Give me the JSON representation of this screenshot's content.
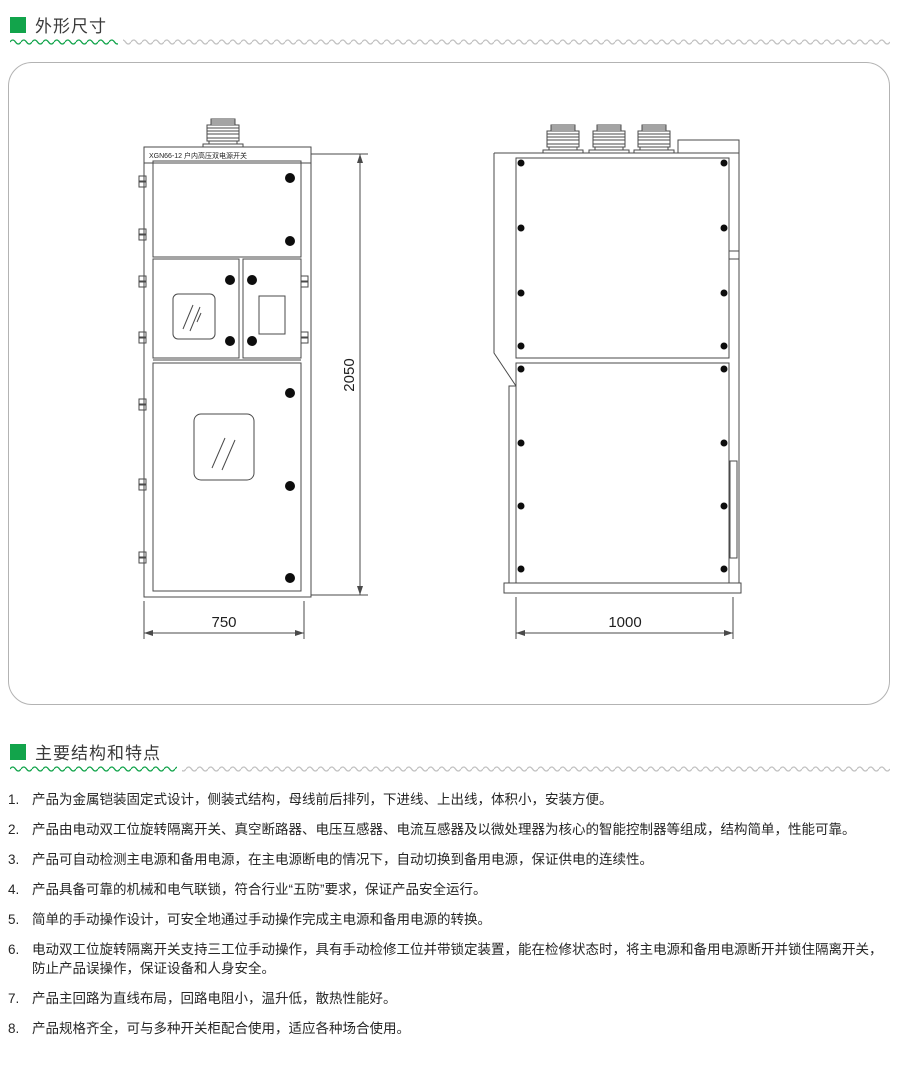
{
  "page": {
    "accent_green": "#12a44b",
    "wave_gray": "#c2c2c2",
    "line_color": "#4a4a4a"
  },
  "sections": [
    {
      "title": "外形尺寸"
    },
    {
      "title": "主要结构和特点"
    }
  ],
  "drawing": {
    "cabinet_label": "XGN66-12 户内高压双电源开关",
    "dimensions": {
      "front_width": "750",
      "height": "2050",
      "side_depth": "1000"
    }
  },
  "features": [
    {
      "num": "1.",
      "text": "产品为金属铠装固定式设计，侧装式结构，母线前后排列，下进线、上出线，体积小，安装方便。"
    },
    {
      "num": "2.",
      "text": "产品由电动双工位旋转隔离开关、真空断路器、电压互感器、电流互感器及以微处理器为核心的智能控制器等组成，结构简单，性能可靠。"
    },
    {
      "num": "3.",
      "text": "产品可自动检测主电源和备用电源，在主电源断电的情况下，自动切换到备用电源，保证供电的连续性。"
    },
    {
      "num": "4.",
      "text": "产品具备可靠的机械和电气联锁，符合行业“五防”要求，保证产品安全运行。"
    },
    {
      "num": "5.",
      "text": "简单的手动操作设计，可安全地通过手动操作完成主电源和备用电源的转换。"
    },
    {
      "num": "6.",
      "text": "电动双工位旋转隔离开关支持三工位手动操作，具有手动检修工位并带锁定装置，能在检修状态时，将主电源和备用电源断开并锁住隔离开关，防止产品误操作，保证设备和人身安全。"
    },
    {
      "num": "7.",
      "text": "产品主回路为直线布局，回路电阻小，温升低，散热性能好。"
    },
    {
      "num": "8.",
      "text": "产品规格齐全，可与多种开关柜配合使用，适应各种场合使用。"
    }
  ]
}
